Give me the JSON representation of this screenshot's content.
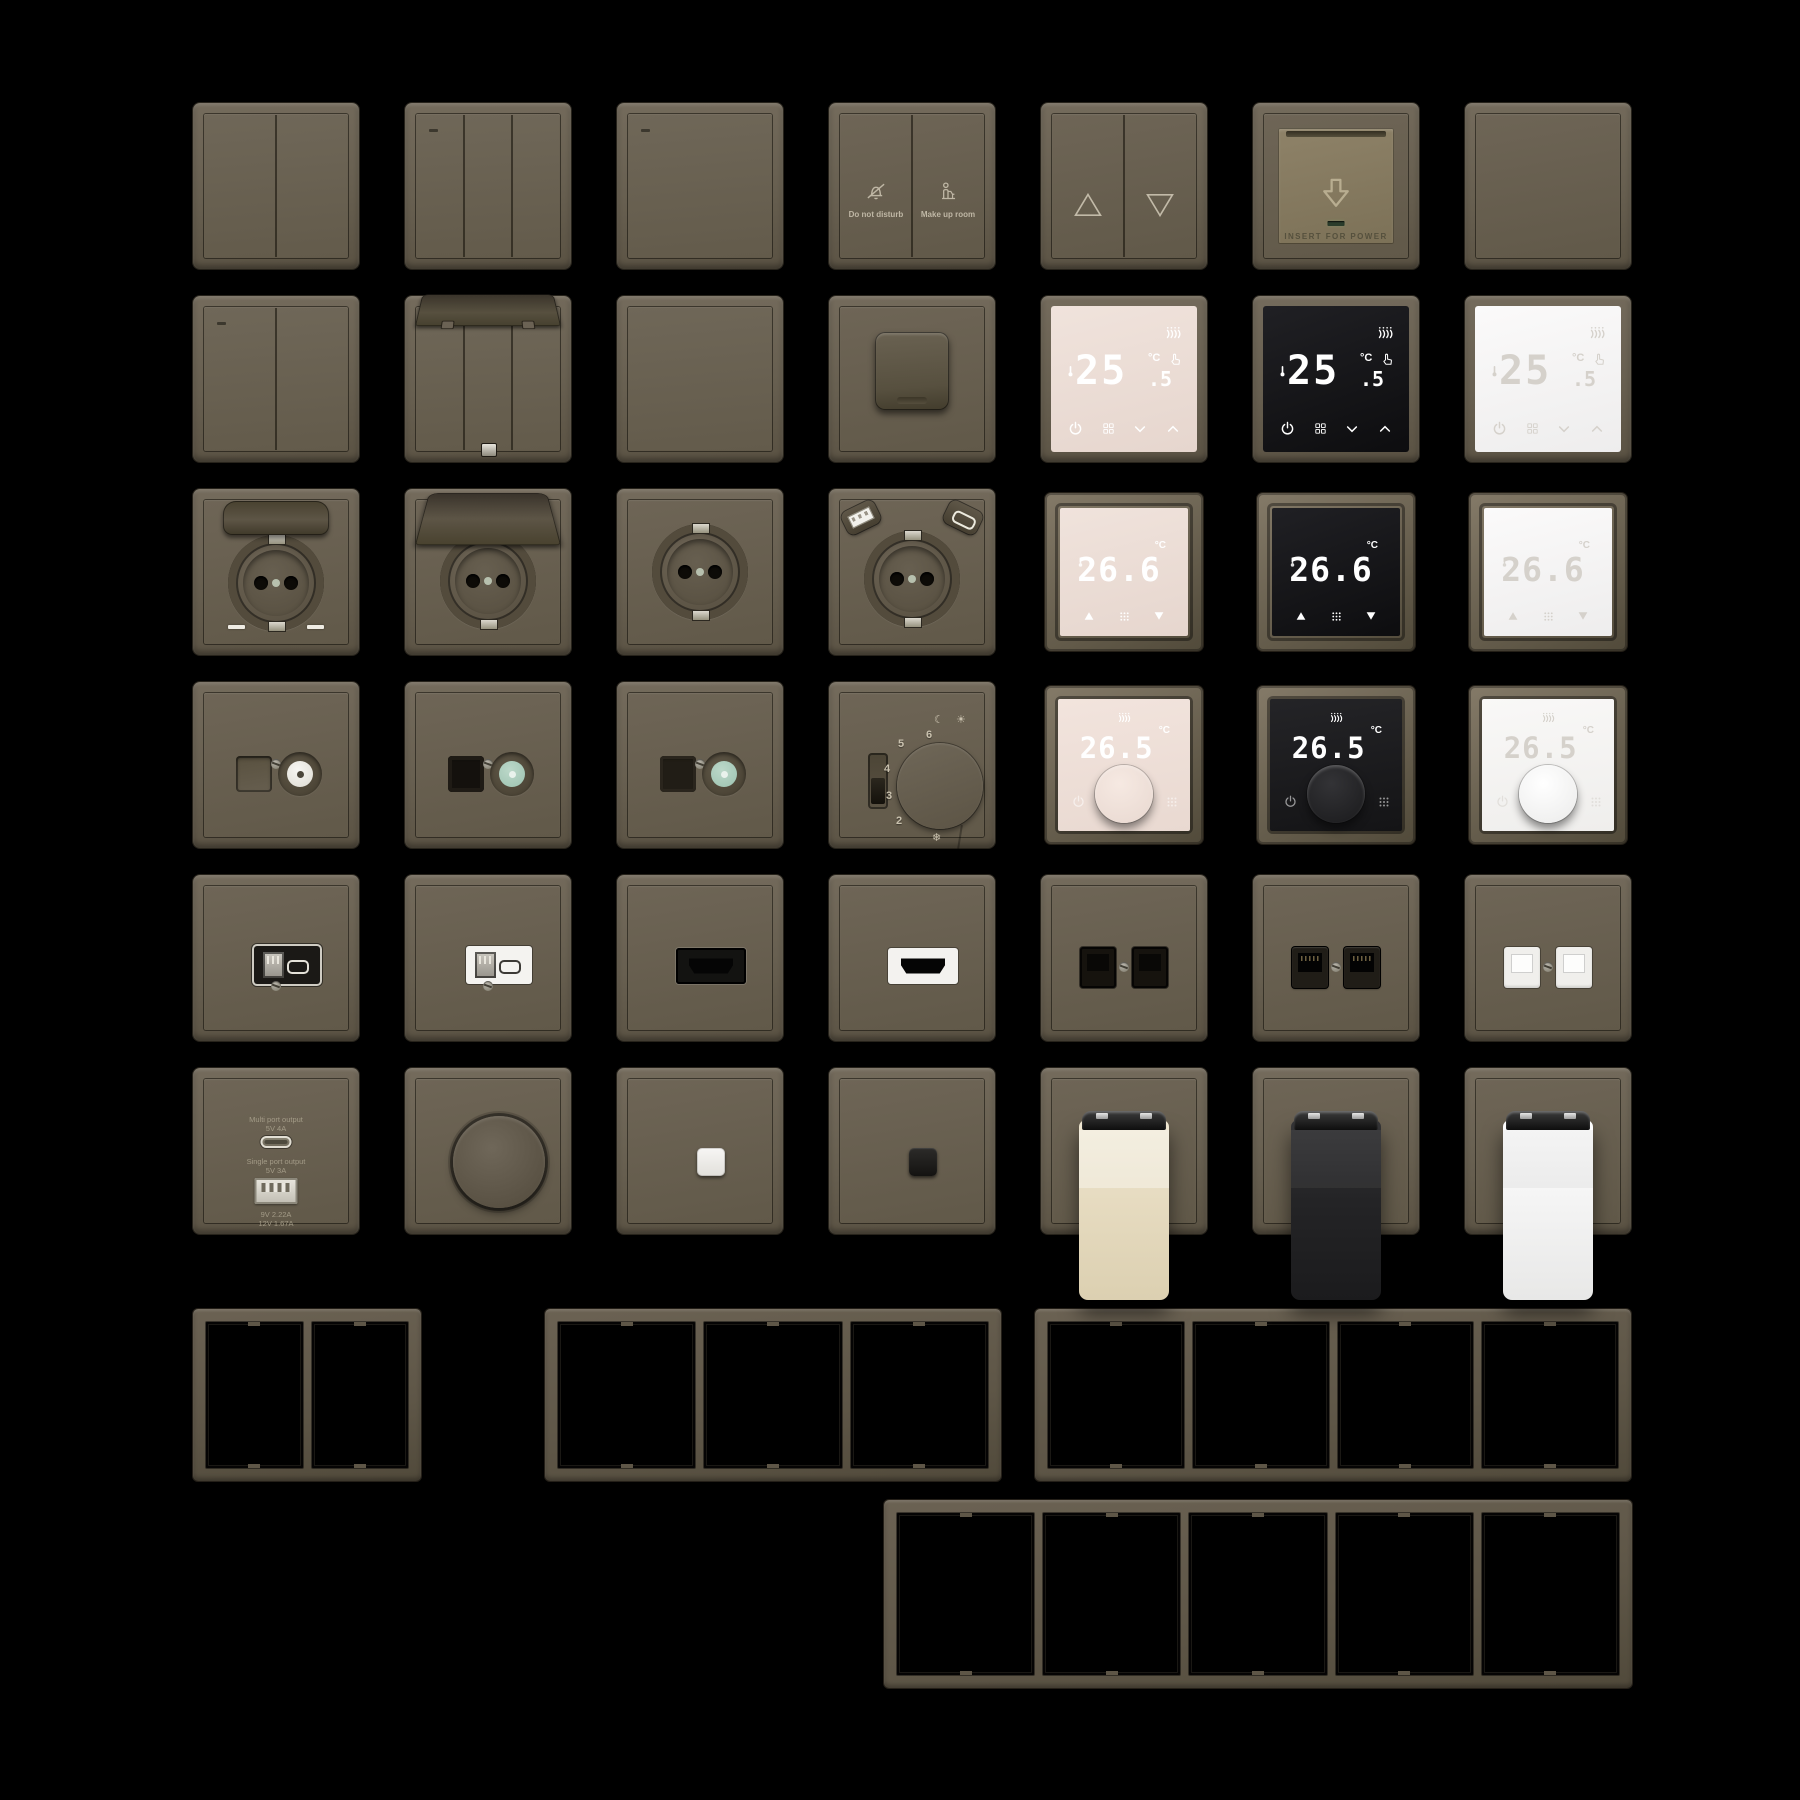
{
  "title": "wall-switch-socket-product-sheet",
  "palette": {
    "background": "#000000",
    "plate_brown": "#6a6153",
    "plate_dark": "#58503f",
    "keycard_face": "#867a61",
    "screen_pink": "#ecdfd8",
    "screen_black": "#131315",
    "screen_white": "#f6f6f6",
    "valve_cream": "#e7dcc2",
    "valve_black": "#232323",
    "valve_white": "#fafafa",
    "accent_teal": "#a9c9ba",
    "led_green": "#2a3c2b"
  },
  "devices": [
    {
      "name": "switch-2gang",
      "type": "switch",
      "row": 1,
      "col": 1,
      "gangs": 2,
      "led": false
    },
    {
      "name": "switch-3gang",
      "type": "switch",
      "row": 1,
      "col": 2,
      "gangs": 3,
      "led": true
    },
    {
      "name": "switch-1gang",
      "type": "switch",
      "row": 1,
      "col": 3,
      "gangs": 1,
      "led": true
    },
    {
      "name": "hotel-service-switch",
      "type": "hotel",
      "row": 1,
      "col": 4,
      "labels": [
        "Do not disturb",
        "Make up room"
      ],
      "icons": [
        "bell-slash",
        "maid"
      ]
    },
    {
      "name": "curtain-switch",
      "type": "curtain",
      "row": 1,
      "col": 5,
      "icons": [
        "triangle-up",
        "triangle-down"
      ]
    },
    {
      "name": "keycard-power-holder",
      "type": "keycard",
      "row": 1,
      "col": 6,
      "label": "INSERT FOR POWER",
      "icon": "arrow-block-down"
    },
    {
      "name": "blank-plate",
      "type": "blank",
      "row": 1,
      "col": 7
    },
    {
      "name": "switch-2gang-led",
      "type": "switch",
      "row": 2,
      "col": 1,
      "gangs": 2,
      "led": true
    },
    {
      "name": "switch-3gang-lid-open",
      "type": "switch",
      "row": 2,
      "col": 2,
      "gangs": 3,
      "led": false,
      "lid": "open-small"
    },
    {
      "name": "switch-1gang-plain",
      "type": "switch",
      "row": 2,
      "col": 3,
      "gangs": 1,
      "led": false
    },
    {
      "name": "socket-flap-closed",
      "type": "socket-covered",
      "row": 2,
      "col": 4
    },
    {
      "name": "thermostat-touch-pink",
      "type": "thermo-touch",
      "row": 2,
      "col": 5,
      "screen": "pink",
      "temp": "25",
      "frac": ".5",
      "unit": "°C"
    },
    {
      "name": "thermostat-touch-black",
      "type": "thermo-touch",
      "row": 2,
      "col": 6,
      "screen": "black",
      "temp": "25",
      "frac": ".5",
      "unit": "°C"
    },
    {
      "name": "thermostat-touch-white",
      "type": "thermo-touch",
      "row": 2,
      "col": 7,
      "screen": "white",
      "temp": "25",
      "frac": ".5",
      "unit": "°C"
    },
    {
      "name": "socket-lid-closed",
      "type": "socket",
      "row": 3,
      "col": 1,
      "lid": "closed",
      "indicators": true
    },
    {
      "name": "socket-lid-open",
      "type": "socket",
      "row": 3,
      "col": 2,
      "lid": "open"
    },
    {
      "name": "socket-schuko",
      "type": "socket",
      "row": 3,
      "col": 3
    },
    {
      "name": "socket-usb-ac",
      "type": "socket",
      "row": 3,
      "col": 4,
      "usb": true
    },
    {
      "name": "thermostat-framed-pink",
      "type": "thermo-framed",
      "row": 3,
      "col": 5,
      "screen": "pink",
      "temp": "26.6",
      "unit": "°C"
    },
    {
      "name": "thermostat-framed-black",
      "type": "thermo-framed",
      "row": 3,
      "col": 6,
      "screen": "black",
      "temp": "26.6",
      "unit": "°C"
    },
    {
      "name": "thermostat-framed-white",
      "type": "thermo-framed",
      "row": 3,
      "col": 7,
      "screen": "white",
      "temp": "26.6",
      "unit": "°C"
    },
    {
      "name": "tv-socket-white",
      "type": "tv",
      "row": 4,
      "col": 1,
      "port": "blank",
      "coax": "white"
    },
    {
      "name": "data-tv-socket-black",
      "type": "tv",
      "row": 4,
      "col": 2,
      "port": "black",
      "coax": "teal"
    },
    {
      "name": "tv-socket-teal",
      "type": "tv",
      "row": 4,
      "col": 3,
      "port": "dark",
      "coax": "teal"
    },
    {
      "name": "thermostat-dial-mechanical",
      "type": "thermo-mech",
      "row": 4,
      "col": 4,
      "numbers": [
        "2",
        "3",
        "4",
        "5",
        "6"
      ],
      "icon_moon": "☾",
      "icon_sun": "☀",
      "icon_frost": "❄"
    },
    {
      "name": "thermostat-knob-pink",
      "type": "thermo-knob",
      "row": 4,
      "col": 5,
      "screen": "pink",
      "temp": "26.5",
      "unit": "°C"
    },
    {
      "name": "thermostat-knob-black",
      "type": "thermo-knob",
      "row": 4,
      "col": 6,
      "screen": "black",
      "temp": "26.5",
      "unit": "°C"
    },
    {
      "name": "thermostat-knob-white",
      "type": "thermo-knob",
      "row": 4,
      "col": 7,
      "screen": "white",
      "temp": "26.5",
      "unit": "°C"
    },
    {
      "name": "usb-outlet-black",
      "type": "usbmod",
      "row": 5,
      "col": 1,
      "insert": "black"
    },
    {
      "name": "usb-outlet-white",
      "type": "usbmod",
      "row": 5,
      "col": 2,
      "insert": "white"
    },
    {
      "name": "hdmi-outlet-black",
      "type": "hdmi",
      "row": 5,
      "col": 3,
      "insert": "black"
    },
    {
      "name": "hdmi-outlet-white",
      "type": "hdmi",
      "row": 5,
      "col": 4,
      "insert": "white"
    },
    {
      "name": "rj45-double-black",
      "type": "rj45",
      "row": 5,
      "col": 5,
      "variant": "black"
    },
    {
      "name": "rj45-double-black-raised",
      "type": "rj45",
      "row": 5,
      "col": 6,
      "variant": "raised"
    },
    {
      "name": "rj45-double-white",
      "type": "rj45",
      "row": 5,
      "col": 7,
      "variant": "white"
    },
    {
      "name": "usb-charger-outlet",
      "type": "charger",
      "row": 6,
      "col": 1,
      "multi_label": "Multi port output",
      "multi_spec": "5V 4A",
      "single_label": "Single port output",
      "single_spec": "5V 3A",
      "spec2": "9V 2.22A",
      "spec3": "12V 1.67A"
    },
    {
      "name": "rotary-dimmer",
      "type": "dimmer",
      "row": 6,
      "col": 2
    },
    {
      "name": "push-button-white",
      "type": "minibtn",
      "row": 6,
      "col": 3,
      "color": "white"
    },
    {
      "name": "push-button-black",
      "type": "minibtn",
      "row": 6,
      "col": 4,
      "color": "black"
    },
    {
      "name": "radiator-valve-cream",
      "type": "valve",
      "row": 6,
      "col": 5,
      "color": "cream"
    },
    {
      "name": "radiator-valve-black",
      "type": "valve",
      "row": 6,
      "col": 6,
      "color": "black"
    },
    {
      "name": "radiator-valve-white",
      "type": "valve",
      "row": 6,
      "col": 7,
      "color": "white"
    }
  ],
  "frames": [
    {
      "name": "frame-2gang",
      "gangs": 2
    },
    {
      "name": "frame-3gang",
      "gangs": 3
    },
    {
      "name": "frame-4gang",
      "gangs": 4
    },
    {
      "name": "frame-5gang",
      "gangs": 5
    }
  ]
}
